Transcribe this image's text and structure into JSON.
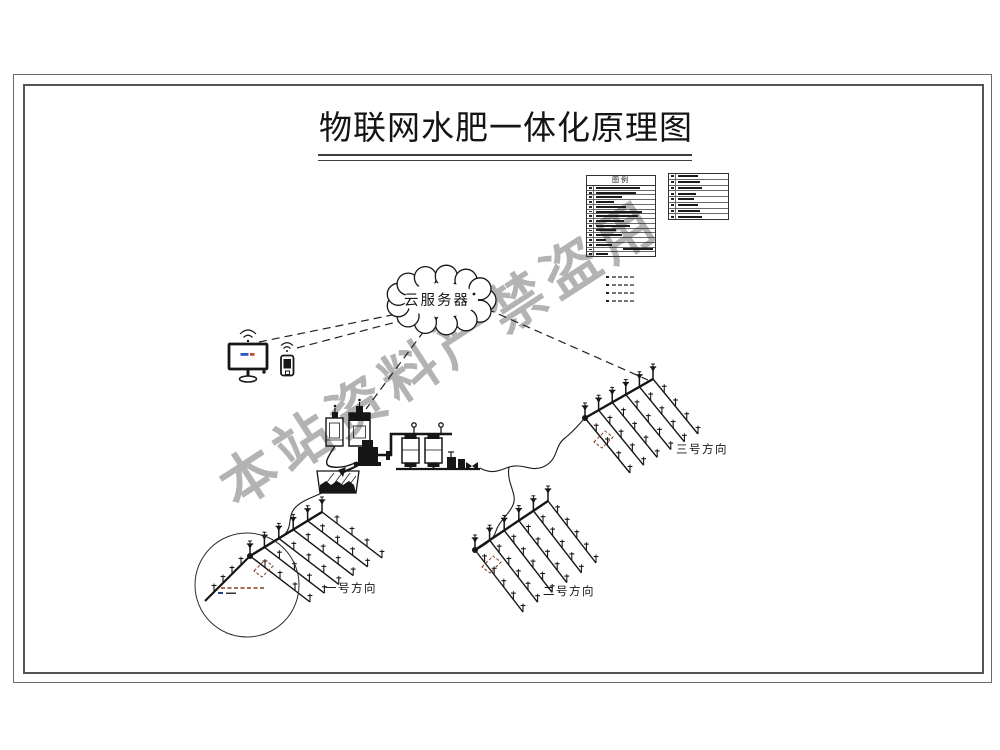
{
  "page": {
    "title": "物联网水肥一体化原理图"
  },
  "watermark": {
    "text": "本站资料严禁盗用"
  },
  "cloud": {
    "label": "云服务器"
  },
  "legend": {
    "header": "图例",
    "left_row_widths": [
      44,
      40,
      26,
      18,
      30,
      46,
      42,
      28,
      34,
      20,
      26,
      10,
      16,
      30,
      12
    ],
    "left_row_aligns": [
      "l",
      "l",
      "l",
      "l",
      "l",
      "l",
      "l",
      "l",
      "l",
      "l",
      "l",
      "l",
      "l",
      "r",
      "l"
    ],
    "right_row_widths": [
      20,
      22,
      24,
      18,
      16,
      20,
      22,
      24
    ],
    "line_style_count": 4
  },
  "palette": {
    "line": "#161616",
    "frame": "#555555",
    "watermark_color": "#9e9e9e",
    "marker_dash": "#8a3a20",
    "screen_dash_blue": "#2b55c8",
    "screen_dash_red": "#c84b2b"
  },
  "diagram": {
    "fields": [
      {
        "label": "一号方向",
        "main": [
          250,
          556,
          322,
          512
        ],
        "pre": [
          205,
          601
        ],
        "pre_sprinklers": 4,
        "laterals": 6,
        "lateral_vec": [
          60,
          46
        ],
        "sprinklers_per_lateral": 4,
        "marker": [
          263,
          568
        ],
        "label_anchor": [
          351,
          592
        ]
      },
      {
        "label": "二号方向",
        "main": [
          475,
          550,
          548,
          501
        ],
        "laterals": 6,
        "lateral_vec": [
          48,
          62
        ],
        "sprinklers_per_lateral": 5,
        "marker": [
          491,
          564
        ],
        "label_anchor": [
          569,
          595
        ]
      },
      {
        "label": "三号方向",
        "main": [
          585,
          418,
          653,
          379
        ],
        "laterals": 6,
        "lateral_vec": [
          45,
          55
        ],
        "sprinklers_per_lateral": 4,
        "marker": [
          603,
          439
        ],
        "label_anchor": [
          702,
          453
        ]
      }
    ],
    "detail_circle": {
      "cx": 247,
      "cy": 585,
      "r": 52
    }
  }
}
